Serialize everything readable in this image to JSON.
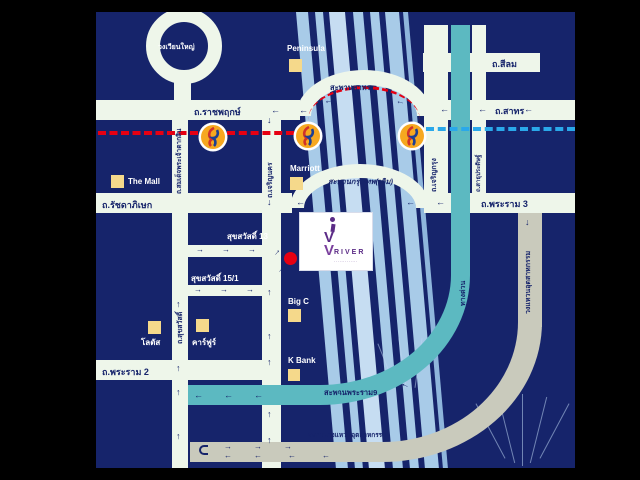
{
  "map": {
    "roundabout_label": "วงเวียนใหญ่",
    "roads": {
      "ratchaphruek": "ถ.ราชพฤกษ์",
      "silom": "ถ.สีลม",
      "sathorn": "ถ.สาทร",
      "taksin": "ถ.สมเด็จพระเจ้าตากสิน",
      "charoen_nakhon": "ถ.เจริญนคร",
      "charoen_krung": "ถ.เจริญกรุง",
      "sathu_pradit": "ถ.สาธุประดิษฐ์",
      "expressway": "ทางด่วน",
      "rama3": "ถ.พระราม 3",
      "industrial_ring": "วงแหวนอุตสาหกรรม",
      "ratchadaphisek": "ถ.รัชดาภิเษก",
      "suksawat": "ถ.สุขสวัสดิ์",
      "rama2": "ถ.พระราม 2",
      "soi_suksawat13": "สุขสวัสดิ์ 13",
      "soi_suksawat15": "สุขสวัสดิ์ 15/1"
    },
    "bridges": {
      "sathorn_bridge": "สะพานสาทร",
      "krungthep_bridge": "สะพานกรุงเทพ(เดิม)",
      "rama9_bridge": "สะพานพระราม9",
      "industrial_ring_bridge": "สะพานวงแหวนอุตสาหกรรม"
    },
    "landmarks": {
      "peninsula": "Peninsula",
      "marriott": "Marriott",
      "the_mall": "The Mall",
      "lotus": "โลตัส",
      "carrefour": "คาร์ฟูร์",
      "bigc": "Big C",
      "kbank": "K Bank"
    },
    "logo": {
      "brand": "RIVER",
      "monogram_i": "i",
      "monogram_v": "V",
      "tagline": "·············"
    }
  },
  "icons": {
    "arrow_left": "←",
    "arrow_right": "→",
    "arrow_up": "↑",
    "arrow_down": "↓"
  },
  "colors": {
    "background": "#000000",
    "map_navy": "#16246b",
    "road_white": "#eef6ea",
    "river_blue": "#a8cbe8",
    "expressway_teal": "#5cb9c1",
    "ring_road_gray": "#c9cabc",
    "landmark_yellow": "#f5d98b",
    "rail_red": "#e60012",
    "rail_blue": "#2aa8ea",
    "station_orange": "#f6a820",
    "logo_purple": "#5b2b86"
  }
}
